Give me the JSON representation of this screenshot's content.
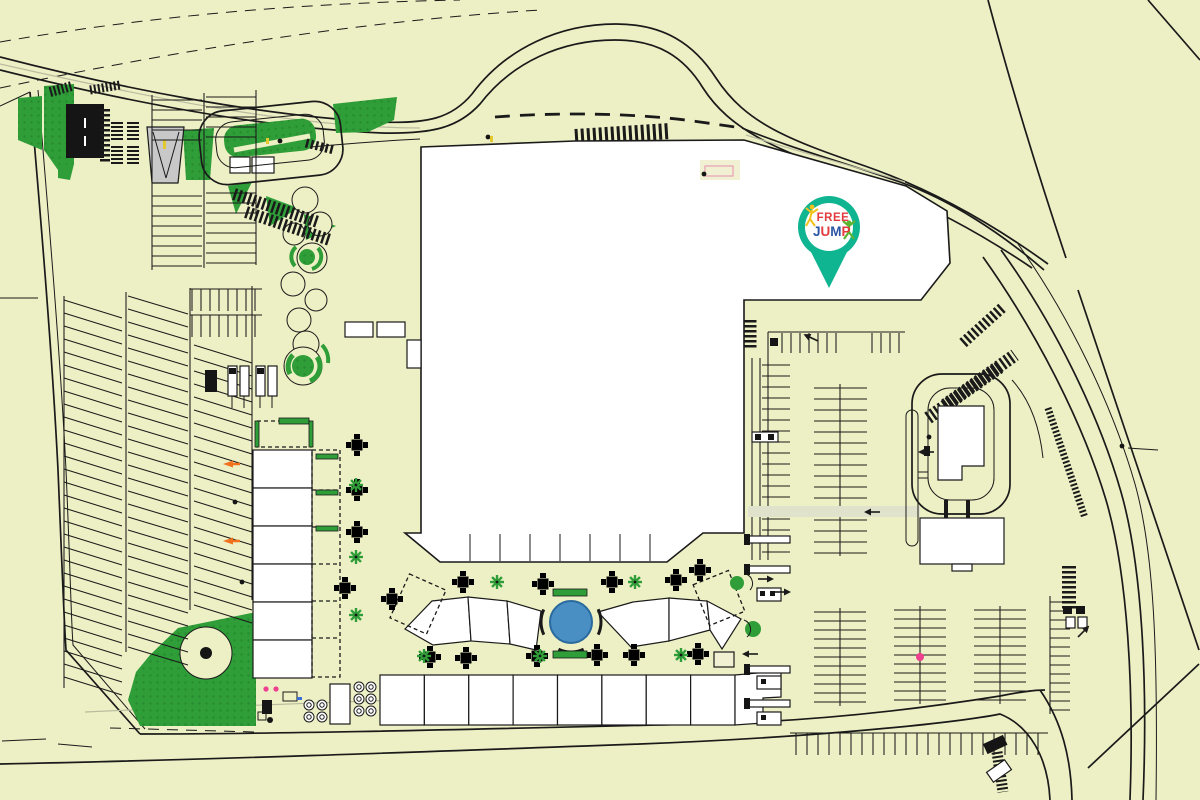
{
  "title": "Shopping centre site plan with Free Jump location pin",
  "colors": {
    "background": "#edefc4",
    "outline": "#1a1a1a",
    "curb_gray": "#b9bb9e",
    "green": "#2f9e38",
    "green_dark": "#1f7f2a",
    "building_fill": "#ffffff",
    "gray_building": "#c8c8c8",
    "black_building": "#151515",
    "fountain_blue": "#4a8fc3",
    "path_light": "#e0e2cb",
    "pale_panel": "#f2f0d2",
    "pink_line": "#e8a0b4",
    "pin_teal": "#0fb591",
    "logo_red": "#e23b3f",
    "logo_blue": "#2b55a5",
    "logo_yellow": "#f2c21c",
    "logo_green": "#5cb531",
    "accent_orange": "#f2711c",
    "accent_pink": "#ef3f8f",
    "accent_blue": "#3a6fd8",
    "yellow_mark": "#e3c82e"
  },
  "pin": {
    "logo_top": "FREE",
    "jump_letters": [
      "J",
      "U",
      "M",
      "P"
    ],
    "figure_left": "yellow-jumper-icon",
    "figure_right": "green-jumper-icon"
  },
  "map": {
    "features": [
      "main-mall-building",
      "free-jump-location-pin",
      "central-plaza-fountain",
      "plaza-kiosks",
      "outdoor-dining-tables",
      "bottom-retail-strip",
      "west-retail-strip",
      "west-parking-lot",
      "northwest-parking-lot",
      "east-parking-lot",
      "southeast-parking-lot",
      "drive-through-restaurant",
      "bus-loop",
      "playground-path-roundabouts",
      "landscaped-greens",
      "perimeter-roads",
      "crosswalk-hatching",
      "cul-de-sac"
    ]
  }
}
